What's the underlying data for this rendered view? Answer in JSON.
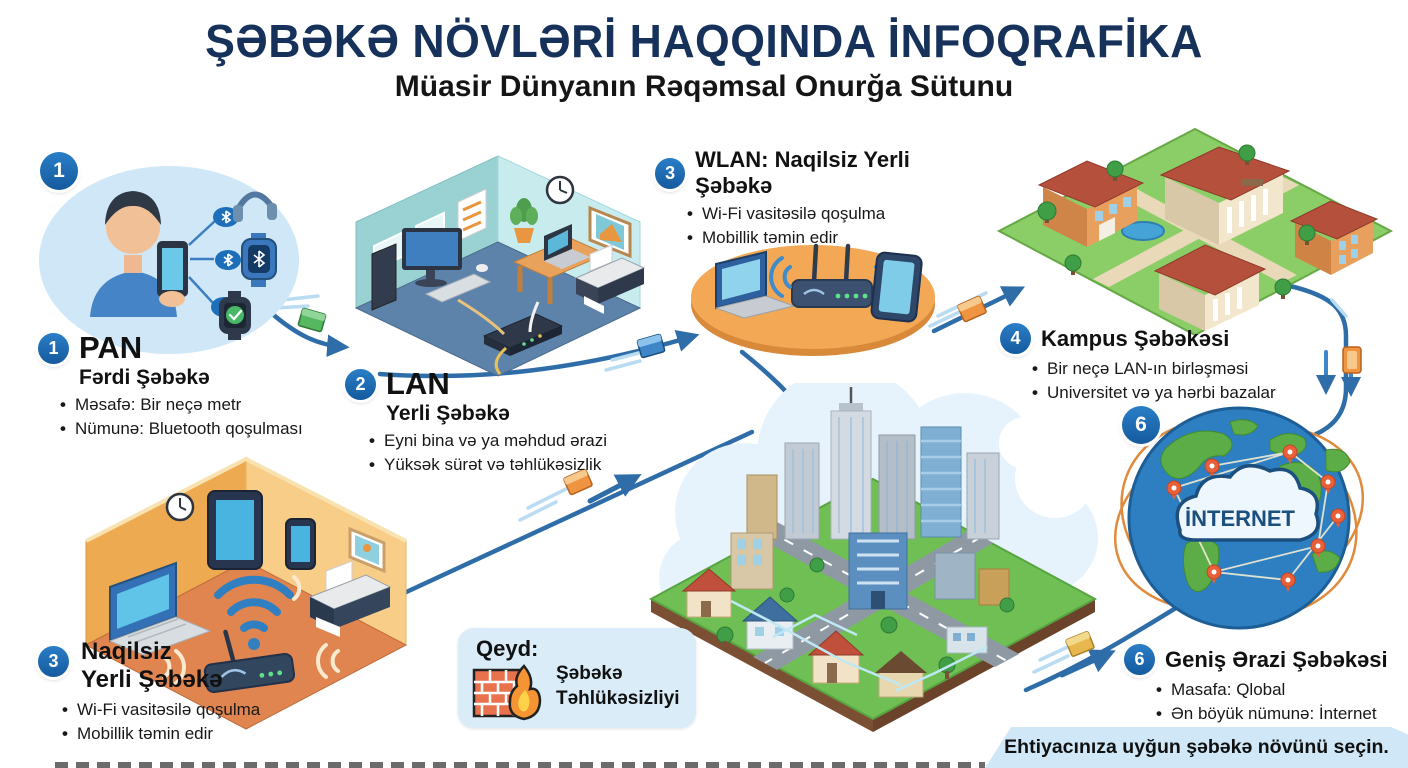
{
  "header": {
    "title": "ŞƏBƏKƏ NÖVLƏRİ HAQQINDA İNFOQRAFİKA",
    "subtitle": "Müasir Dünyanın Rəqəmsal Onurğa Sütunu"
  },
  "sections": {
    "pan": {
      "badge": "1",
      "name": "PAN",
      "subtitle": "Fərdi Şəbəkə",
      "bullets": [
        "Məsafə: Bir neçə metr",
        "Nümunə: Bluetooth qoşulması"
      ]
    },
    "lan": {
      "badge": "2",
      "name": "LAN",
      "subtitle": "Yerli Şəbəkə",
      "bullets": [
        "Eyni bina və ya məhdud ərazi",
        "Yüksək sürət və təhlükəsizlik"
      ]
    },
    "wlan": {
      "badge": "3",
      "title": "WLAN: Naqilsiz Yerli Şəbəkə",
      "bullets": [
        "Wi-Fi vasitəsilə qoşulma",
        "Mobillik təmin edir"
      ]
    },
    "campus": {
      "badge": "4",
      "title": "Kampus Şəbəkəsi",
      "bullets": [
        "Bir neçə LAN-ın birləşməsi",
        "Universitet və ya hərbi bazalar"
      ]
    },
    "wlan_home": {
      "badge": "3",
      "title_line1": "Naqilsiz",
      "title_line2": "Yerli Şəbəkə",
      "bullets": [
        "Wi-Fi vasitəsilə qoşulma",
        "Mobillik təmin edir"
      ]
    },
    "wan": {
      "badge": "6",
      "title": "Geniş Ərazi Şəbəkəsi",
      "bullets": [
        "Masafa: Qlobal",
        "Ən böyük nümunə: İnternet"
      ],
      "globe_label": "İNTERNET"
    }
  },
  "note": {
    "heading": "Qeyd:",
    "line1": "Şəbəkə",
    "line2": "Təhlükəsizliyi"
  },
  "footer": {
    "message": "Ehtiyacınıza uyğun şəbəkə növünü seçin."
  },
  "icons": [
    "bluetooth-icon",
    "headphones-icon",
    "smartwatch-icon",
    "wifi-icon",
    "router-icon",
    "laptop-icon",
    "printer-icon",
    "firewall-icon",
    "globe-icon",
    "internet-cloud-icon",
    "data-packet-icon",
    "arrow-icon"
  ],
  "colors": {
    "title_navy": "#16325a",
    "badge_blue": "#1b6cb8",
    "line_blue": "#2e6da8",
    "pan_bubble": "#cfe7f7",
    "platform_orange": "#f2a855",
    "room_orange": "#edaa50",
    "room_teal": "#9ad2d3",
    "note_bg": "#d9ecf8",
    "banner_bg": "#cfe7f6",
    "packet_green": "#57b660",
    "packet_blue": "#3f86c9",
    "packet_orange": "#ef9440",
    "grass_green": "#6fbf55",
    "globe_blue": "#2d7fc1",
    "continent_green": "#5cad48",
    "pin_orange": "#e8603a"
  }
}
